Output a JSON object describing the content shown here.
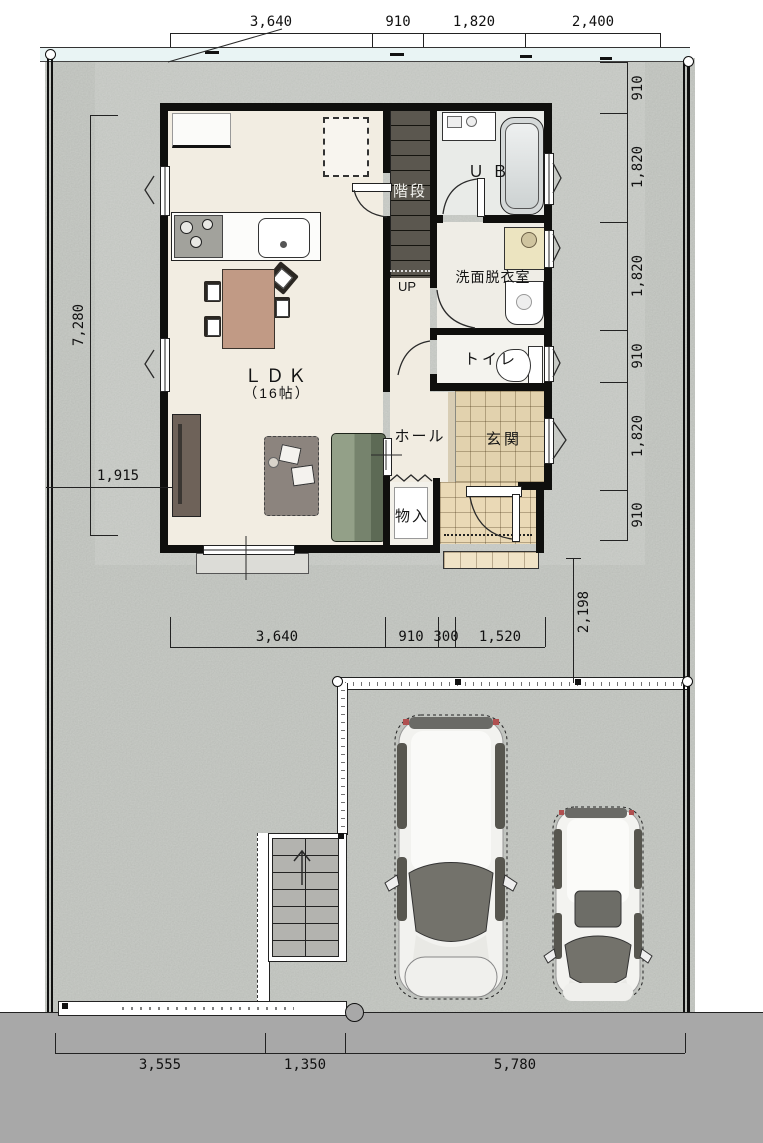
{
  "drawing": {
    "type": "site-and-floor-plan",
    "floor_label": "1F"
  },
  "rooms": {
    "ldk": "ＬＤＫ",
    "ldk_size": "（16帖）",
    "stairs": "階段",
    "stairs_up": "UP",
    "bath": "ＵＢ",
    "washroom": "洗面脱衣室",
    "toilet": "トイレ",
    "hall": "ホール",
    "entry": "玄関",
    "storage": "物入"
  },
  "dimensions": {
    "top": [
      "3,640",
      "910",
      "1,820",
      "2,400"
    ],
    "right": [
      "910",
      "1,820",
      "1,820",
      "910",
      "1,820",
      "910"
    ],
    "left_total": "7,280",
    "left_offset": "1,915",
    "inner": [
      "3,640",
      "910",
      "300",
      "1,520"
    ],
    "approach": "2,198",
    "bottom": [
      "3,555",
      "1,350",
      "5,780"
    ]
  },
  "colors": {
    "gravel": "#a4a7a1",
    "road": "#a8a8a8",
    "road_band": "#e9f4f4",
    "wall": "#0f0f0d",
    "floor_cream": "#f2ede2",
    "entry_tile": "#e2d2ae",
    "porch_tile": "#ead9b6",
    "stair_dark": "#5b574f",
    "sofa_green": "#76836d",
    "table_brown": "#c19a85",
    "rug_gray": "#8c847e",
    "bath_gray": "#d4d8d8"
  }
}
